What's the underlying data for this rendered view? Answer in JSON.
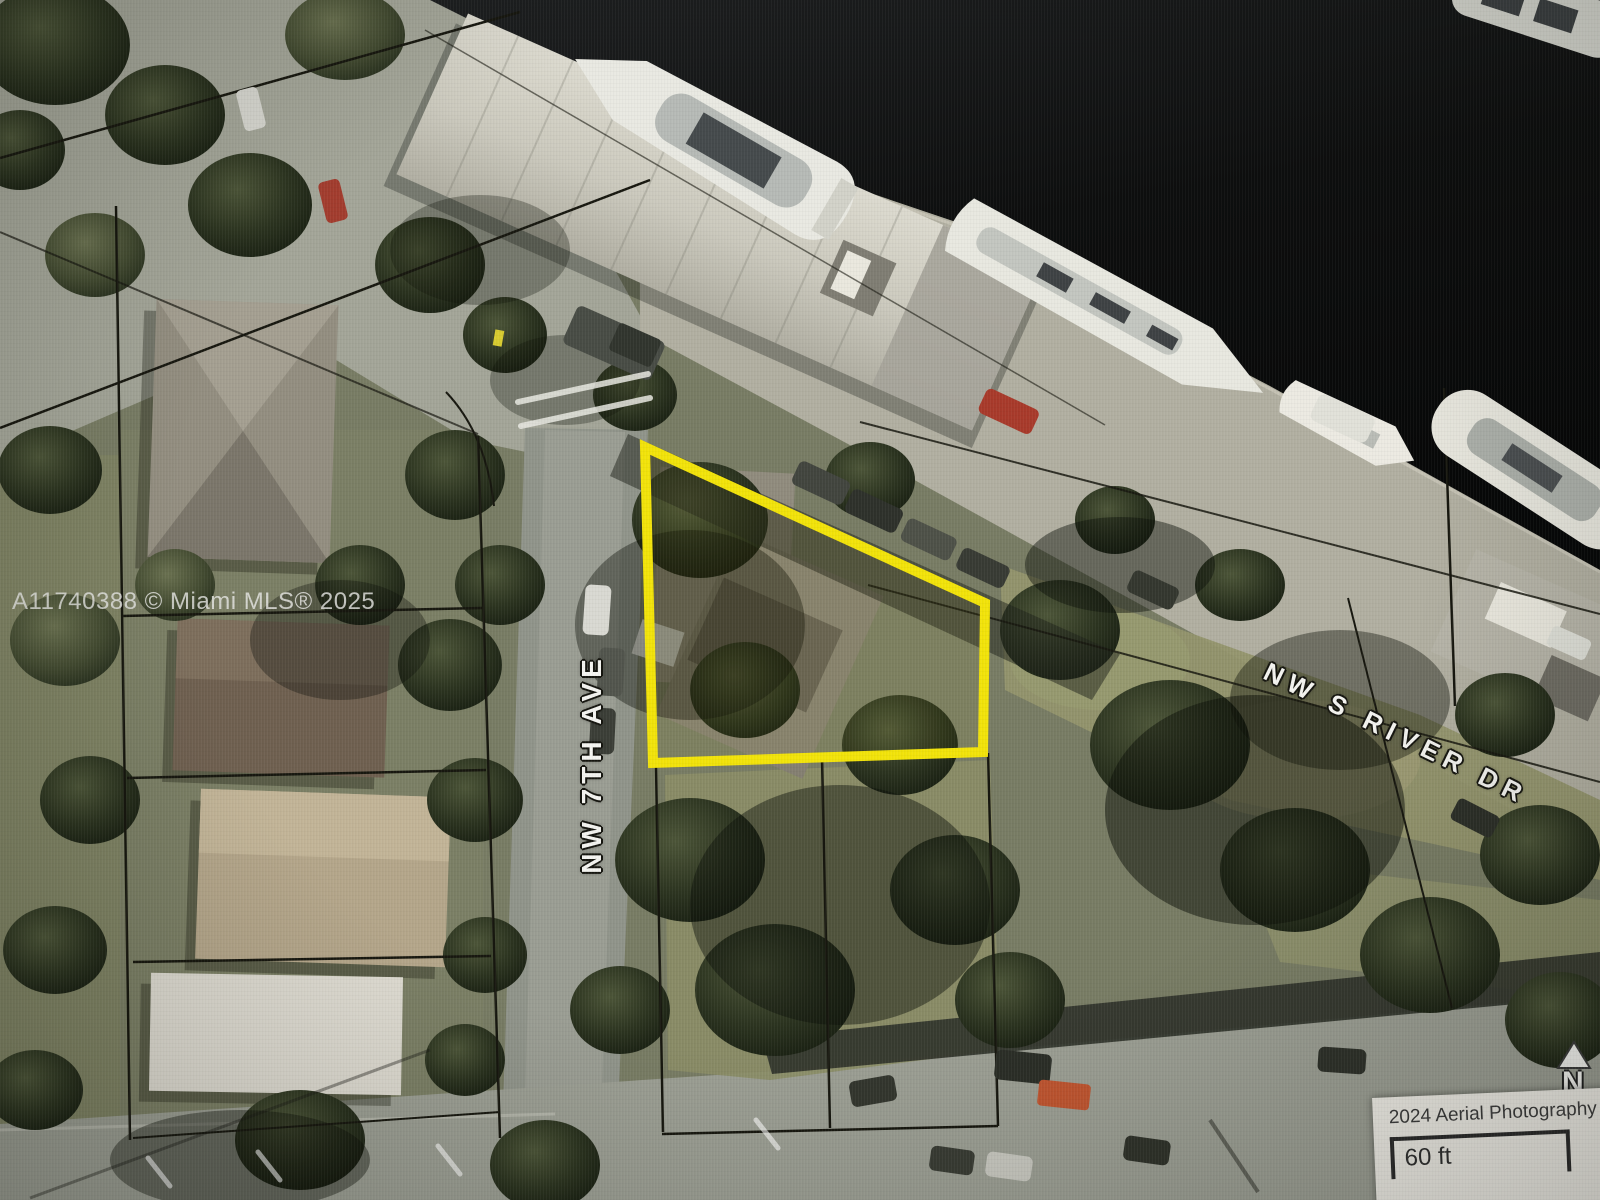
{
  "map": {
    "watermark": "A11740388 © Miami MLS® 2025",
    "streets": {
      "vertical_label": "NW 7TH AVE",
      "diagonal_label": "NW S RIVER DR"
    },
    "scale_box": {
      "title": "2024 Aerial Photography",
      "distance_label": "60 ft"
    },
    "compass": {
      "north_label": "N"
    },
    "colors": {
      "lot_highlight": "#F2E30A",
      "water": "#0B0C0B",
      "parcel_line": "#17170F",
      "street_label_text": "#F4F4F0"
    }
  }
}
